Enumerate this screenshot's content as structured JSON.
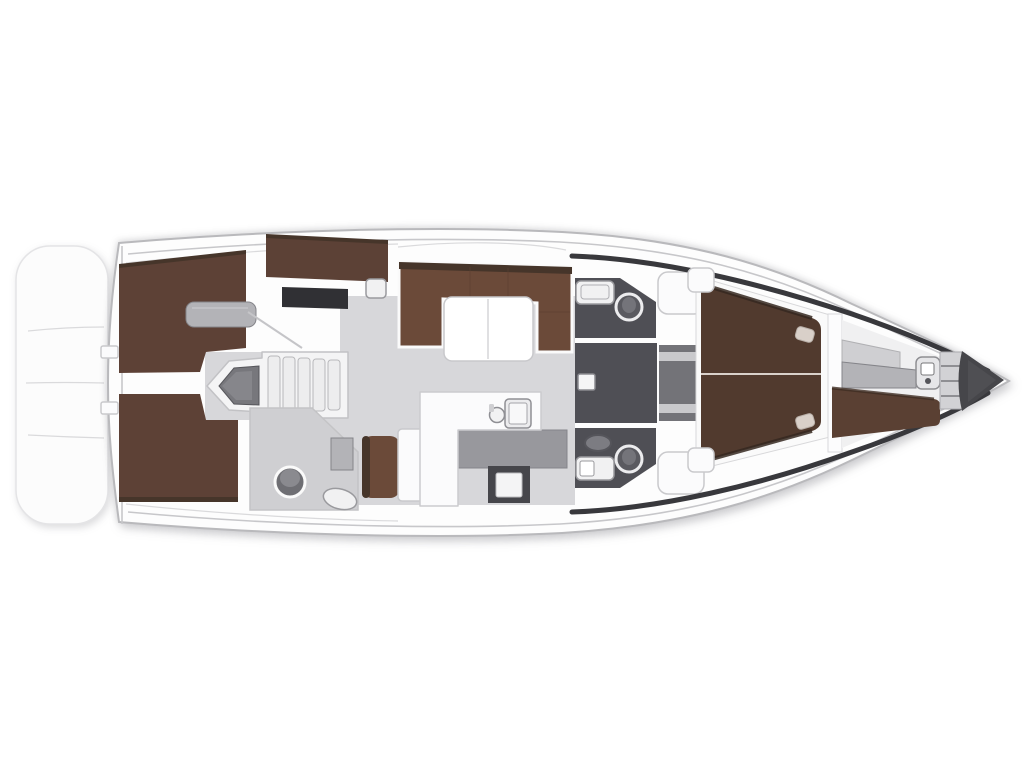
{
  "meta": {
    "description": "Sailing yacht interior layout plan, bow pointing right",
    "width": 1024,
    "height": 768
  },
  "palette": {
    "background": "#ffffff",
    "hull_fill": "#fdfdfd",
    "hull_stroke": "#b9b9bc",
    "platform_fill": "#fcfcfc",
    "platform_stroke": "#e4e4e6",
    "deck_line": "#c7c7ca",
    "deck_line_faint": "#dadadc",
    "floor_light": "#d7d7da",
    "floor_head": "#cfcfd2",
    "dark_floor": "#4f4f55",
    "bed_brown": "#5d4136",
    "settee_brown": "#6b4a39",
    "bed_dark_brown": "#513a2e",
    "berth_brown": "#5a4033",
    "panel_brown": "#5c4136",
    "brown_shadow": "#46352a",
    "wall_white": "#fbfbfc",
    "outline_gray": "#c9c9cc",
    "fixture_white": "#f1f1f2",
    "fixture_stroke": "#9a9a9e",
    "counter_gray": "#98989d",
    "counter_stroke": "#85858a",
    "desk_dark": "#303034",
    "oven_dark": "#46464b",
    "locker_gray": "#b3b3b7",
    "anchor_dark": "#46464a",
    "lining_dark": "#38383c",
    "door_gray": "#737378",
    "door_bar": "#c9c9cc"
  },
  "regions": {
    "swim_platform": {
      "label": "Swim platform with steps"
    },
    "hull": {
      "label": "Hull outline"
    },
    "aft_cabin_port": {
      "label": "Port aft double cabin"
    },
    "aft_cabin_starboard": {
      "label": "Starboard aft double cabin"
    },
    "wardrobe_area": {
      "label": "Port wardrobe and locker"
    },
    "companionway": {
      "label": "Companionway steps and engine box"
    },
    "aft_head": {
      "label": "Aft bathroom with toilet and sink"
    },
    "salon": {
      "label": "Salon U-shaped settee with folding table"
    },
    "nav_station": {
      "label": "Navigation seat and chart table"
    },
    "galley": {
      "label": "L-shaped galley with sinks and stove"
    },
    "head_port": {
      "label": "Port mid bathroom"
    },
    "head_starboard": {
      "label": "Starboard mid bathroom"
    },
    "corridor": {
      "label": "Corridor with mast step"
    },
    "forward_cabin": {
      "label": "Forward owner cabin with double berth"
    },
    "forepeak": {
      "label": "Forepeak skipper berth and windlass"
    },
    "anchor_locker": {
      "label": "Anchor locker"
    }
  }
}
